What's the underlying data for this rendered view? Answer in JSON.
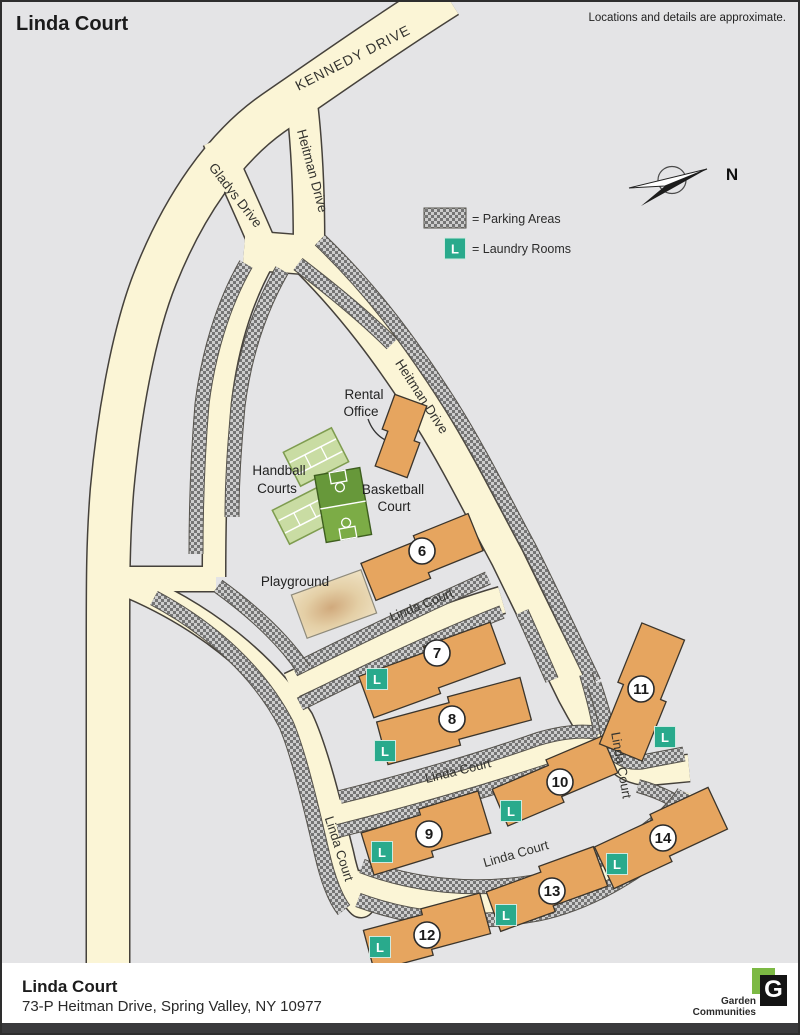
{
  "header": {
    "title": "Linda Court",
    "disclaimer": "Locations and details are approximate."
  },
  "legend": {
    "parking": "= Parking Areas",
    "laundry": "= Laundry Rooms",
    "laundry_letter": "L"
  },
  "compass": {
    "north": "N"
  },
  "map": {
    "streets": [
      {
        "t": "KENNEDY DRIVE",
        "x": 353,
        "y": 60,
        "r": -27,
        "fs": 14,
        "ls": 1
      },
      {
        "t": "Heitman Drive",
        "x": 306,
        "y": 170,
        "r": 75,
        "fs": 13.5,
        "ls": 0
      },
      {
        "t": "Gladys Drive",
        "x": 230,
        "y": 196,
        "r": 52,
        "fs": 13.5,
        "ls": 0
      },
      {
        "t": "Heitman Drive",
        "x": 416,
        "y": 397,
        "r": 57,
        "fs": 13.5,
        "ls": 0
      },
      {
        "t": "Linda Court",
        "x": 421,
        "y": 607,
        "r": -22,
        "fs": 13,
        "ls": 0
      },
      {
        "t": "Linda Court",
        "x": 457,
        "y": 773,
        "r": -14,
        "fs": 13,
        "ls": 0
      },
      {
        "t": "Linda Court",
        "x": 615,
        "y": 764,
        "r": 80,
        "fs": 13,
        "ls": 0
      },
      {
        "t": "Linda Court",
        "x": 333,
        "y": 848,
        "r": 72,
        "fs": 13,
        "ls": 0
      },
      {
        "t": "Linda Court",
        "x": 515,
        "y": 856,
        "r": -16,
        "fs": 13,
        "ls": 0
      }
    ],
    "facility_labels": [
      {
        "id": "rental-office",
        "lines": [
          {
            "t": "Rental",
            "x": 362,
            "y": 397
          },
          {
            "t": "Office",
            "x": 359,
            "y": 414
          }
        ]
      },
      {
        "id": "handball-courts",
        "lines": [
          {
            "t": "Handball",
            "x": 277,
            "y": 473
          },
          {
            "t": "Courts",
            "x": 275,
            "y": 491
          }
        ]
      },
      {
        "id": "basketball-court",
        "lines": [
          {
            "t": "Basketball",
            "x": 391,
            "y": 492
          },
          {
            "t": "Court",
            "x": 392,
            "y": 509
          }
        ]
      },
      {
        "id": "playground",
        "lines": [
          {
            "t": "Playground",
            "x": 293,
            "y": 584
          }
        ]
      }
    ],
    "rental_office": {
      "cx": 399,
      "cy": 434,
      "len": 74,
      "wid": 34,
      "rot": -70
    },
    "buildings": [
      {
        "number": "6",
        "cx": 420,
        "cy": 555,
        "len": 118,
        "wid": 40,
        "rot": -22,
        "circle": [
          420,
          549
        ]
      },
      {
        "number": "7",
        "cx": 430,
        "cy": 668,
        "len": 142,
        "wid": 44,
        "rot": -20,
        "circle": [
          435,
          651
        ]
      },
      {
        "number": "8",
        "cx": 452,
        "cy": 719,
        "len": 150,
        "wid": 44,
        "rot": -15,
        "circle": [
          450,
          717
        ]
      },
      {
        "number": "9",
        "cx": 424,
        "cy": 831,
        "len": 124,
        "wid": 44,
        "rot": -17,
        "circle": [
          427,
          832
        ]
      },
      {
        "number": "10",
        "cx": 553,
        "cy": 779,
        "len": 122,
        "wid": 40,
        "rot": -23,
        "circle": [
          558,
          780
        ]
      },
      {
        "number": "11",
        "cx": 640,
        "cy": 690,
        "len": 128,
        "wid": 46,
        "rot": -68,
        "circle": [
          639,
          687
        ]
      },
      {
        "number": "12",
        "cx": 425,
        "cy": 930,
        "len": 122,
        "wid": 42,
        "rot": -15,
        "circle": [
          425,
          933
        ]
      },
      {
        "number": "13",
        "cx": 545,
        "cy": 887,
        "len": 116,
        "wid": 42,
        "rot": -20,
        "circle": [
          550,
          889
        ]
      },
      {
        "number": "14",
        "cx": 659,
        "cy": 836,
        "len": 128,
        "wid": 46,
        "rot": -25,
        "circle": [
          661,
          836
        ]
      }
    ],
    "laundry_positions": [
      [
        375,
        677
      ],
      [
        383,
        749
      ],
      [
        380,
        850
      ],
      [
        509,
        809
      ],
      [
        663,
        735
      ],
      [
        378,
        945
      ],
      [
        504,
        913
      ],
      [
        615,
        862
      ]
    ]
  },
  "footer": {
    "title": "Linda Court",
    "address": "73-P Heitman Drive, Spring Valley, NY 10977",
    "logo": {
      "letter": "G",
      "line1": "Garden",
      "line2": "Communities",
      "tm": "TM"
    }
  },
  "colors": {
    "background": "#E4E4E6",
    "road": "#FBF5D6",
    "road_casing": "#45413B",
    "building": "#E6A55F",
    "laundry_teal": "#29AA8C",
    "court_light": "#C9DCA3",
    "court_dark": "#6FA03A",
    "playground_tan": "#E9D9B9"
  }
}
